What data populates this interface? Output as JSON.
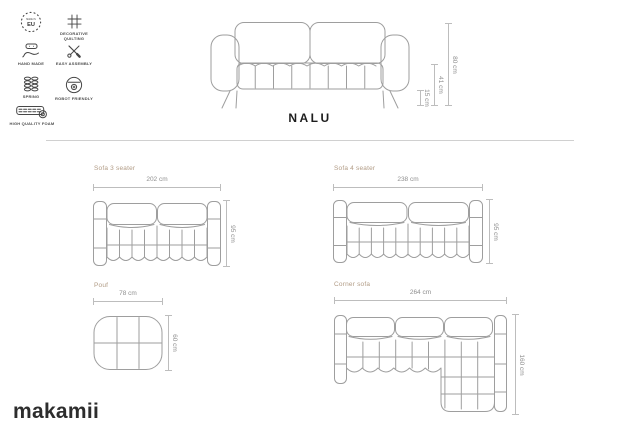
{
  "brand": {
    "logo_text": "makamii"
  },
  "product": {
    "title": "NALU"
  },
  "features": {
    "eu": {
      "label_top": "MADE IN",
      "badge": "EU"
    },
    "quilting": {
      "label": "DECORATIVE QUILTING"
    },
    "handmade": {
      "label": "HAND MADE"
    },
    "assembly": {
      "label": "EASY ASSEMBLY"
    },
    "spring": {
      "label": "SPRING"
    },
    "robot": {
      "label": "ROBOT FRIENDLY"
    },
    "foam": {
      "label": "HIGH QUALITY FOAM"
    }
  },
  "front_view": {
    "total_height": "80 cm",
    "seat_height": "41 cm",
    "leg_height": "15 cm"
  },
  "variants": {
    "sofa3": {
      "label": "Sofa 3 seater",
      "width": "202 cm",
      "depth": "95 cm"
    },
    "sofa4": {
      "label": "Sofa 4 seater",
      "width": "238 cm",
      "depth": "95 cm"
    },
    "pouf": {
      "label": "Pouf",
      "width": "78 cm",
      "depth": "60 cm"
    },
    "corner": {
      "label": "Corner sofa",
      "width": "264 cm",
      "depth": "160 cm"
    }
  },
  "colors": {
    "accent_label": "#b19b85",
    "drawing_line": "#9e9e9e",
    "dimension_line": "#bdbdbd",
    "dimension_text": "#8f8f8f",
    "text_dark": "#1d1d1d"
  }
}
